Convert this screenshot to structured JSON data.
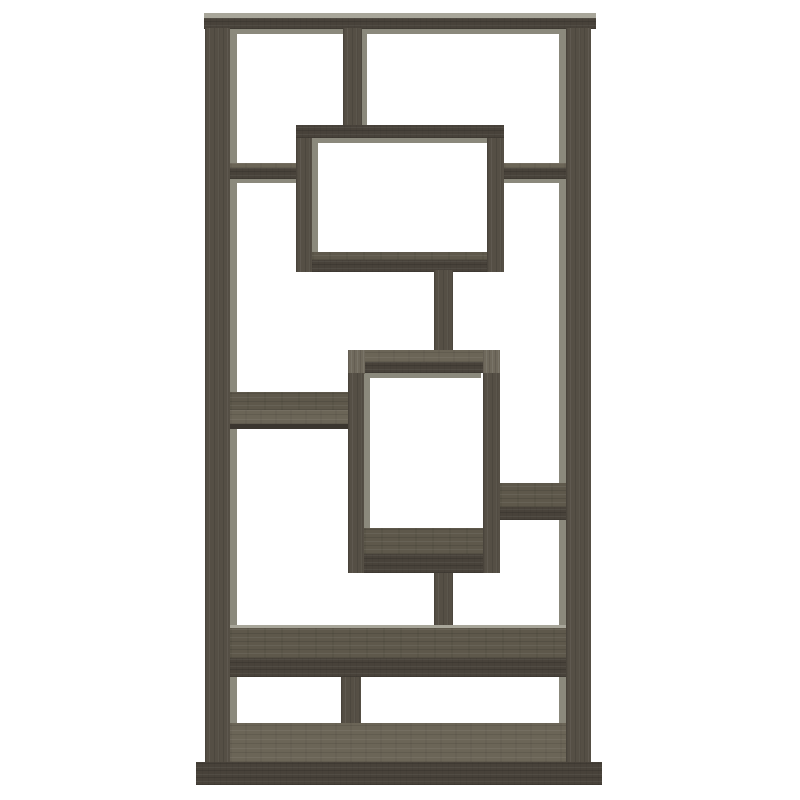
{
  "meta": {
    "description": "Product photo: 10-shelf geometric staggered bookcase / display etagere in weathered grey wood finish, front view on plain white background, no text or UI controls"
  },
  "palette": {
    "background": "#ffffff",
    "wood_front": "#48423a",
    "wood_vertical": "#554f45",
    "wood_top": "#5e584b",
    "wood_top_light": "#6b6557",
    "wood_cap": "#6f695c",
    "wood_dark": "#3b362f",
    "back_edge": "#8b897c",
    "highlight": "#a8a69a"
  },
  "figure": {
    "name": "geometric-bookcase",
    "canvas": {
      "width": 800,
      "height": 800
    },
    "pieces": [
      {
        "n": "top-bar-back-edge",
        "k": "edge",
        "x": 230,
        "y": 28,
        "w": 336,
        "h": 6
      },
      {
        "n": "left-panel-back-edge",
        "k": "edge",
        "x": 230,
        "y": 28,
        "w": 7,
        "h": 734
      },
      {
        "n": "right-panel-back-edge",
        "k": "edge",
        "x": 559,
        "y": 28,
        "w": 7,
        "h": 734
      },
      {
        "n": "center-divider-back-edge",
        "k": "edge",
        "x": 362,
        "y": 30,
        "w": 5,
        "h": 95
      },
      {
        "n": "box1-inner-top-edge",
        "k": "edge",
        "x": 312,
        "y": 138,
        "w": 175,
        "h": 5
      },
      {
        "n": "box1-inner-left-edge",
        "k": "edge",
        "x": 312,
        "y": 138,
        "w": 6,
        "h": 118
      },
      {
        "n": "box2-inner-top-edge",
        "k": "edge",
        "x": 364,
        "y": 373,
        "w": 117,
        "h": 5
      },
      {
        "n": "box2-inner-left-edge",
        "k": "edge",
        "x": 364,
        "y": 373,
        "w": 6,
        "h": 157
      },
      {
        "n": "upper-left-shelf-under-edge",
        "k": "edge",
        "x": 230,
        "y": 179,
        "w": 66,
        "h": 4
      },
      {
        "n": "upper-right-shelf-under-edge",
        "k": "edge",
        "x": 504,
        "y": 179,
        "w": 62,
        "h": 4
      },
      {
        "n": "top-bar-top-surface",
        "k": "hl",
        "x": 204,
        "y": 13,
        "w": 392,
        "h": 5
      },
      {
        "n": "top-bar-front",
        "k": "hfront",
        "x": 204,
        "y": 18,
        "w": 392,
        "h": 11
      },
      {
        "n": "center-divider",
        "k": "vgrain",
        "x": 343,
        "y": 28,
        "w": 19,
        "h": 97
      },
      {
        "n": "left-side-panel",
        "k": "vgrain",
        "x": 205,
        "y": 28,
        "w": 25,
        "h": 737
      },
      {
        "n": "right-side-panel",
        "k": "vgrain",
        "x": 566,
        "y": 28,
        "w": 25,
        "h": 737
      },
      {
        "n": "upper-left-shelf-top",
        "k": "htoplight",
        "x": 230,
        "y": 163,
        "w": 66,
        "h": 5
      },
      {
        "n": "upper-left-shelf-front",
        "k": "hfront",
        "x": 230,
        "y": 168,
        "w": 66,
        "h": 11
      },
      {
        "n": "upper-right-shelf-top",
        "k": "htoplight",
        "x": 504,
        "y": 163,
        "w": 62,
        "h": 5
      },
      {
        "n": "upper-right-shelf-front",
        "k": "hfront",
        "x": 504,
        "y": 168,
        "w": 62,
        "h": 11
      },
      {
        "n": "box1-top",
        "k": "hfront",
        "x": 296,
        "y": 125,
        "w": 208,
        "h": 13
      },
      {
        "n": "box1-bottom-surface",
        "k": "htop",
        "x": 312,
        "y": 252,
        "w": 175,
        "h": 8
      },
      {
        "n": "box1-bottom-front",
        "k": "hfront",
        "x": 312,
        "y": 260,
        "w": 175,
        "h": 12
      },
      {
        "n": "box1-left-side",
        "k": "vgrain",
        "x": 296,
        "y": 138,
        "w": 16,
        "h": 134
      },
      {
        "n": "box1-right-side",
        "k": "vgrain",
        "x": 487,
        "y": 138,
        "w": 17,
        "h": 134
      },
      {
        "n": "upper-connector-post",
        "k": "vgrain",
        "x": 434,
        "y": 270,
        "w": 19,
        "h": 80
      },
      {
        "n": "mid-left-shelf-top",
        "k": "htop",
        "x": 230,
        "y": 392,
        "w": 118,
        "h": 18
      },
      {
        "n": "mid-left-shelf-front",
        "k": "htoplight",
        "x": 230,
        "y": 410,
        "w": 118,
        "h": 14
      },
      {
        "n": "mid-left-shelf-under-line",
        "k": "darkline",
        "x": 230,
        "y": 424,
        "w": 118,
        "h": 5
      },
      {
        "n": "box2-top-surface",
        "k": "htoplight",
        "x": 348,
        "y": 350,
        "w": 152,
        "h": 12
      },
      {
        "n": "box2-top-front",
        "k": "hfront",
        "x": 348,
        "y": 362,
        "w": 152,
        "h": 11
      },
      {
        "n": "box2-corner-cap-left",
        "k": "cap",
        "x": 348,
        "y": 350,
        "w": 17,
        "h": 24
      },
      {
        "n": "box2-corner-cap-right",
        "k": "cap",
        "x": 483,
        "y": 350,
        "w": 17,
        "h": 24
      },
      {
        "n": "box2-bottom-surface",
        "k": "htop",
        "x": 364,
        "y": 528,
        "w": 119,
        "h": 26
      },
      {
        "n": "box2-bottom-front",
        "k": "hfront",
        "x": 348,
        "y": 554,
        "w": 152,
        "h": 19
      },
      {
        "n": "box2-left-side",
        "k": "vgrain",
        "x": 348,
        "y": 373,
        "w": 16,
        "h": 200
      },
      {
        "n": "box2-right-side",
        "k": "vgrain",
        "x": 483,
        "y": 373,
        "w": 17,
        "h": 200
      },
      {
        "n": "mid-right-shelf-top",
        "k": "htop",
        "x": 500,
        "y": 483,
        "w": 66,
        "h": 24
      },
      {
        "n": "mid-right-shelf-front",
        "k": "hfront",
        "x": 500,
        "y": 507,
        "w": 66,
        "h": 13
      },
      {
        "n": "lower-connector-post",
        "k": "vgrain",
        "x": 434,
        "y": 573,
        "w": 19,
        "h": 54
      },
      {
        "n": "wide-shelf-highlight",
        "k": "hl",
        "x": 230,
        "y": 625,
        "w": 336,
        "h": 3
      },
      {
        "n": "wide-shelf-top",
        "k": "htop",
        "x": 230,
        "y": 628,
        "w": 336,
        "h": 30
      },
      {
        "n": "wide-shelf-front",
        "k": "hfront",
        "x": 230,
        "y": 658,
        "w": 336,
        "h": 19
      },
      {
        "n": "bottom-divider",
        "k": "vgrain",
        "x": 341,
        "y": 677,
        "w": 20,
        "h": 46
      },
      {
        "n": "bottom-floor-surface",
        "k": "htoplight",
        "x": 230,
        "y": 723,
        "w": 336,
        "h": 39
      },
      {
        "n": "base-plinth-front",
        "k": "hfront",
        "x": 196,
        "y": 762,
        "w": 406,
        "h": 23
      }
    ]
  }
}
